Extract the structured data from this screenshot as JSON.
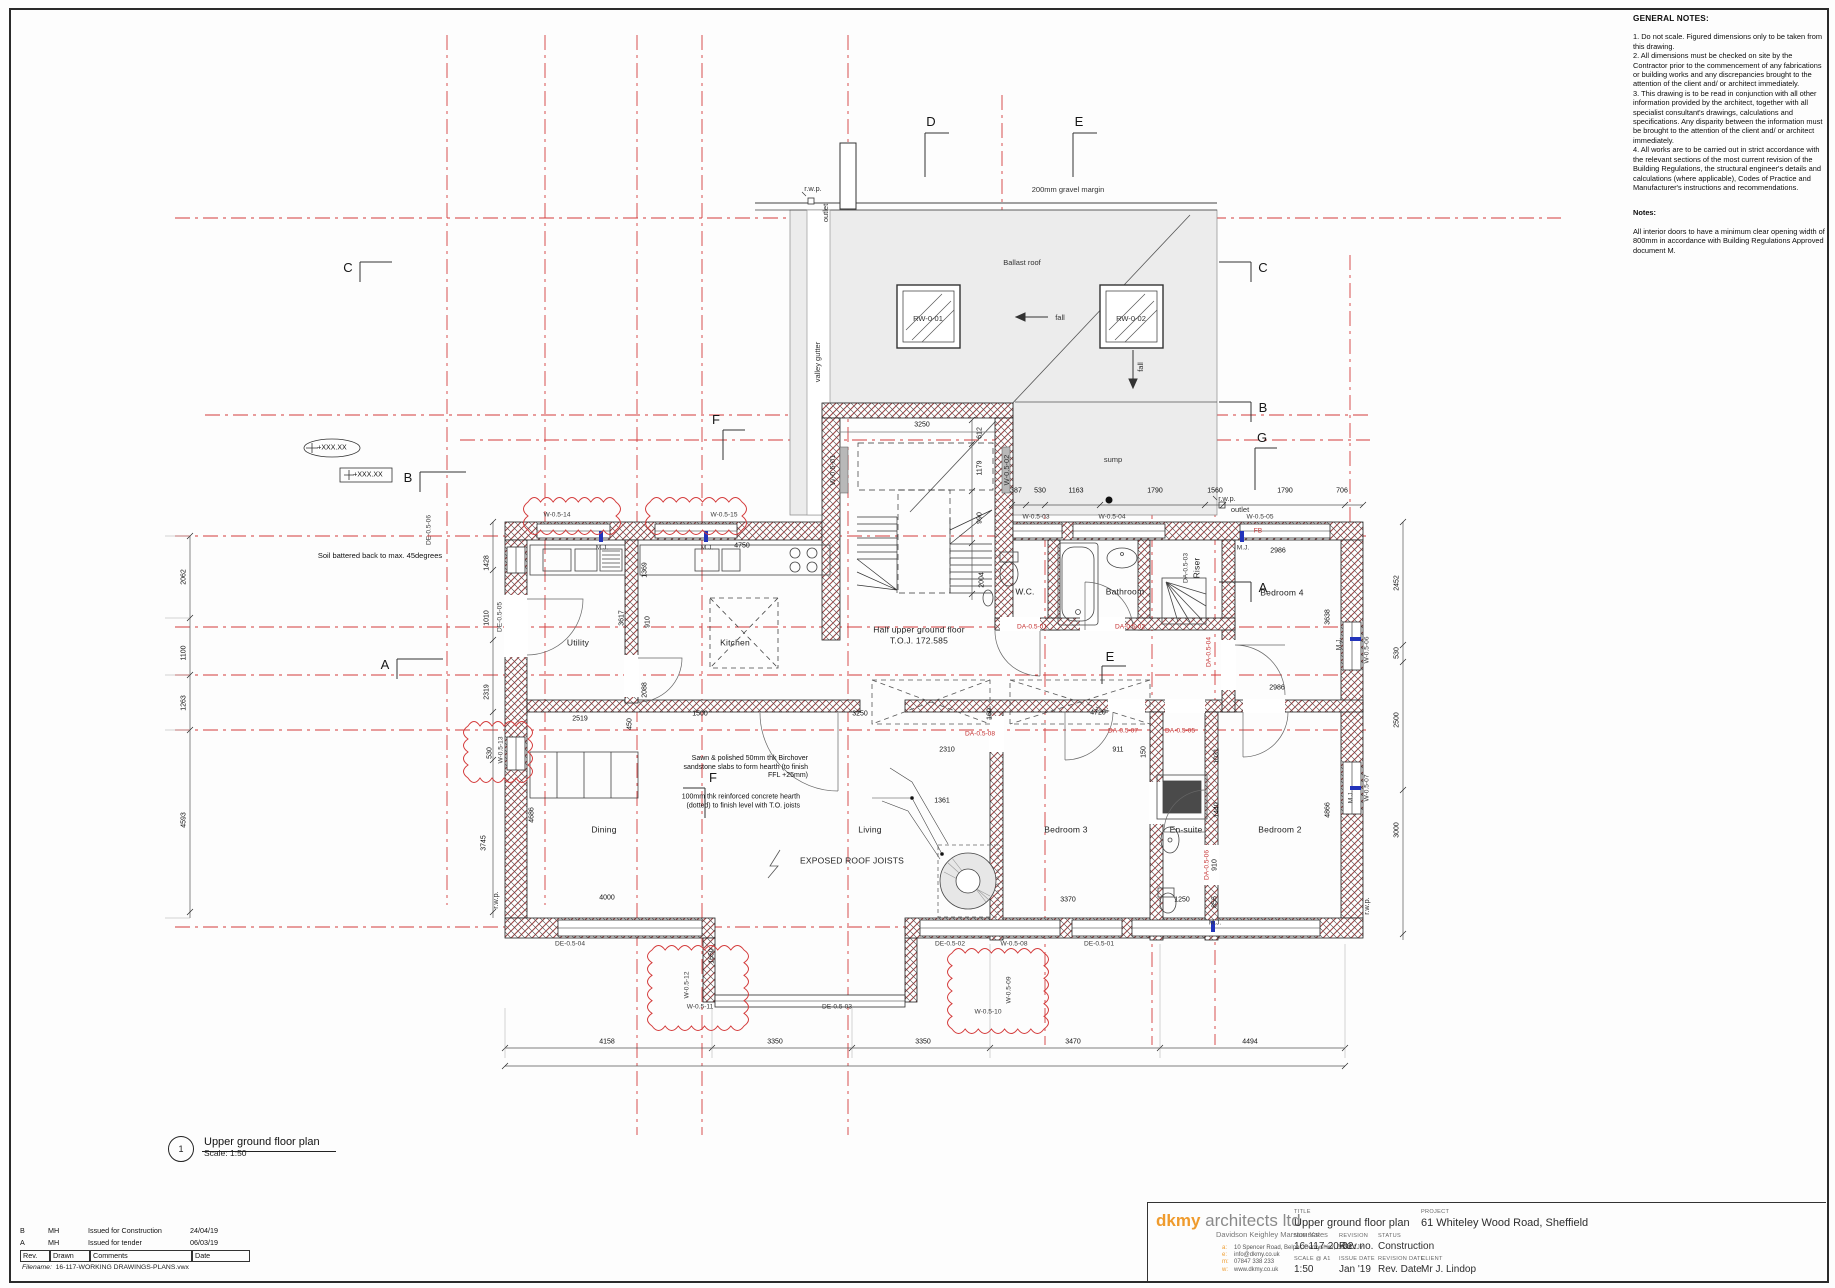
{
  "sheet": {
    "type": "architectural drawing"
  },
  "general_notes": {
    "heading": "GENERAL NOTES:",
    "body": "1. Do not scale. Figured dimensions only to be taken from this drawing.\n2. All dimensions must be checked on site by the Contractor prior to the commencement of any fabrications or building works and any discrepancies brought to the attention of the client and/ or architect immediately.\n3. This drawing is to be read in conjunction with all other information provided by the architect, together with all specialist consultant's drawings, calculations and specifications. Any disparity between the information must be brought to the attention of the client and/ or architect immediately.\n4. All works are to be carried out in strict accordance with the relevant sections of the most current revision of the Building Regulations, the structural engineer's details and calculations (where applicable), Codes of Practice and Manufacturer's instructions and recommendations.",
    "notes_heading": "Notes:",
    "notes_body": "All interior doors to have a minimum clear opening width of 800mm in accordance with Building Regulations Approved document M."
  },
  "plan_title": {
    "number": "1",
    "title": "Upper ground floor plan",
    "scale": "Scale: 1:50"
  },
  "revision_table": {
    "rows": [
      {
        "rev": "B",
        "drawn": "MH",
        "comments": "Issued for Construction",
        "date": "24/04/19"
      },
      {
        "rev": "A",
        "drawn": "MH",
        "comments": "Issued for tender",
        "date": "06/03/19"
      }
    ],
    "header": {
      "rev": "Rev.",
      "drawn": "Drawn",
      "comments": "Comments",
      "date": "Date"
    },
    "filename_label": "Filename:",
    "filename": "16-117-WORKING DRAWINGS-PLANS.vwx"
  },
  "title_block": {
    "logo_bold": "dkmy",
    "logo_rest": " architects ltd",
    "logo_sub": "Davidson Keighley Marston Yates",
    "contact": [
      {
        "k": "a:",
        "v": "10 Spencer Road, Belper, Derbyshire, DE56 1JY"
      },
      {
        "k": "e:",
        "v": "info@dkmy.co.uk"
      },
      {
        "k": "m:",
        "v": "07847 338 233"
      },
      {
        "k": "w:",
        "v": "www.dkmy.co.uk"
      }
    ],
    "title_label": "TITLE",
    "title": "Upper ground floor plan",
    "number_label": "NUMBER",
    "number": "16-117-20-02",
    "revision_label": "REVISION",
    "revision": "Rev no.",
    "status_label": "STATUS",
    "status": "Construction",
    "scale_label": "SCALE @ A1",
    "scale": "1:50",
    "issue_label": "ISSUE DATE",
    "issue": "Jan '19",
    "revdate_label": "REVISION DATE",
    "revdate": "Rev. Date",
    "project_label": "PROJECT",
    "project": "61 Whiteley Wood Road, Sheffield",
    "client_label": "CLIENT",
    "client": "Mr J. Lindop",
    "accent_color": "#ef9b2d"
  },
  "plan": {
    "grid_color": "#d43c3c",
    "rooms": [
      {
        "t": "Utility",
        "x": 578,
        "y": 643
      },
      {
        "t": "Kitchen",
        "x": 735,
        "y": 643
      },
      {
        "t": "Half upper ground floor",
        "x": 919,
        "y": 630
      },
      {
        "t": "T.O.J. 172.585",
        "x": 919,
        "y": 641
      },
      {
        "t": "W.C.",
        "x": 1025,
        "y": 592
      },
      {
        "t": "Bathroom",
        "x": 1125,
        "y": 592
      },
      {
        "t": "Riser",
        "x": 1197,
        "y": 568,
        "r": 1
      },
      {
        "t": "Bedroom 4",
        "x": 1282,
        "y": 593
      },
      {
        "t": "Dining",
        "x": 604,
        "y": 830
      },
      {
        "t": "Living",
        "x": 870,
        "y": 830
      },
      {
        "t": "EXPOSED ROOF JOISTS",
        "x": 852,
        "y": 861
      },
      {
        "t": "Bedroom 3",
        "x": 1066,
        "y": 830
      },
      {
        "t": "En-suite",
        "x": 1186,
        "y": 830
      },
      {
        "t": "Bedroom 2",
        "x": 1280,
        "y": 830
      }
    ],
    "roof_labels": [
      {
        "t": "200mm gravel margin",
        "x": 1068,
        "y": 190
      },
      {
        "t": "Ballast roof",
        "x": 1022,
        "y": 263
      },
      {
        "t": "RW-0-01",
        "x": 928,
        "y": 319
      },
      {
        "t": "RW-0-02",
        "x": 1131,
        "y": 319
      },
      {
        "t": "fall",
        "x": 1060,
        "y": 318
      },
      {
        "t": "fall",
        "x": 1141,
        "y": 367,
        "r": 1
      },
      {
        "t": "sump",
        "x": 1113,
        "y": 460
      },
      {
        "t": "valley gutter",
        "x": 818,
        "y": 362,
        "r": 1
      },
      {
        "t": "r.w.p.",
        "x": 813,
        "y": 189
      },
      {
        "t": "outlet",
        "x": 826,
        "y": 213,
        "r": 1
      },
      {
        "t": "r.w.p.",
        "x": 1227,
        "y": 499
      },
      {
        "t": "outlet",
        "x": 1240,
        "y": 510
      },
      {
        "t": "r.w.p.",
        "x": 496,
        "y": 900,
        "r": 1
      },
      {
        "t": "r.w.p.",
        "x": 1367,
        "y": 906,
        "r": 1
      },
      {
        "t": "W-0.5-01",
        "x": 833,
        "y": 470,
        "r": 1
      },
      {
        "t": "W-0.5-02",
        "x": 1007,
        "y": 470,
        "r": 1
      }
    ],
    "grid_letters": [
      {
        "t": "D",
        "x": 931,
        "y": 122
      },
      {
        "t": "E",
        "x": 1079,
        "y": 122
      },
      {
        "t": "C",
        "x": 348,
        "y": 268
      },
      {
        "t": "C",
        "x": 1263,
        "y": 268
      },
      {
        "t": "B",
        "x": 408,
        "y": 478
      },
      {
        "t": "B",
        "x": 1263,
        "y": 408
      },
      {
        "t": "A",
        "x": 385,
        "y": 665
      },
      {
        "t": "A",
        "x": 1263,
        "y": 588
      },
      {
        "t": "F",
        "x": 716,
        "y": 420
      },
      {
        "t": "F",
        "x": 713,
        "y": 778
      },
      {
        "t": "G",
        "x": 1262,
        "y": 438
      },
      {
        "t": "E",
        "x": 1110,
        "y": 657
      }
    ],
    "dims": [
      {
        "t": "387",
        "x": 1016,
        "y": 491
      },
      {
        "t": "530",
        "x": 1040,
        "y": 491
      },
      {
        "t": "1163",
        "x": 1076,
        "y": 491
      },
      {
        "t": "1790",
        "x": 1155,
        "y": 491
      },
      {
        "t": "1560",
        "x": 1215,
        "y": 491
      },
      {
        "t": "1790",
        "x": 1285,
        "y": 491
      },
      {
        "t": "706",
        "x": 1342,
        "y": 491
      },
      {
        "t": "3250",
        "x": 922,
        "y": 425
      },
      {
        "t": "612",
        "x": 980,
        "y": 433,
        "r": 1
      },
      {
        "t": "1179",
        "x": 980,
        "y": 468,
        "r": 1
      },
      {
        "t": "990",
        "x": 980,
        "y": 518,
        "r": 1
      },
      {
        "t": "2004",
        "x": 982,
        "y": 580,
        "r": 1
      },
      {
        "t": "2062",
        "x": 184,
        "y": 577,
        "r": 1
      },
      {
        "t": "1100",
        "x": 184,
        "y": 653,
        "r": 1
      },
      {
        "t": "1263",
        "x": 184,
        "y": 703,
        "r": 1
      },
      {
        "t": "4593",
        "x": 184,
        "y": 820,
        "r": 1
      },
      {
        "t": "1428",
        "x": 487,
        "y": 563,
        "r": 1
      },
      {
        "t": "1010",
        "x": 487,
        "y": 618,
        "r": 1
      },
      {
        "t": "2319",
        "x": 487,
        "y": 692,
        "r": 1
      },
      {
        "t": "530",
        "x": 490,
        "y": 753,
        "r": 1
      },
      {
        "t": "3745",
        "x": 484,
        "y": 843,
        "r": 1
      },
      {
        "t": "4686",
        "x": 532,
        "y": 815,
        "r": 1
      },
      {
        "t": "1369",
        "x": 645,
        "y": 570,
        "r": 1
      },
      {
        "t": "3617",
        "x": 622,
        "y": 618,
        "r": 1
      },
      {
        "t": "910",
        "x": 648,
        "y": 622,
        "r": 1
      },
      {
        "t": "2088",
        "x": 645,
        "y": 690,
        "r": 1
      },
      {
        "t": "4750",
        "x": 742,
        "y": 546
      },
      {
        "t": "2519",
        "x": 580,
        "y": 719
      },
      {
        "t": "450",
        "x": 630,
        "y": 724,
        "r": 1
      },
      {
        "t": "1500",
        "x": 700,
        "y": 714
      },
      {
        "t": "3250",
        "x": 860,
        "y": 714
      },
      {
        "t": "160",
        "x": 990,
        "y": 714,
        "r": 1
      },
      {
        "t": "4720",
        "x": 1098,
        "y": 713
      },
      {
        "t": "4000",
        "x": 607,
        "y": 898
      },
      {
        "t": "1650",
        "x": 712,
        "y": 956,
        "r": 1
      },
      {
        "t": "1361",
        "x": 942,
        "y": 801
      },
      {
        "t": "2310",
        "x": 947,
        "y": 750
      },
      {
        "t": "911",
        "x": 1118,
        "y": 750
      },
      {
        "t": "150",
        "x": 1144,
        "y": 752,
        "r": 1
      },
      {
        "t": "3370",
        "x": 1068,
        "y": 900
      },
      {
        "t": "1250",
        "x": 1182,
        "y": 900
      },
      {
        "t": "2986",
        "x": 1278,
        "y": 551
      },
      {
        "t": "2986",
        "x": 1277,
        "y": 688
      },
      {
        "t": "3638",
        "x": 1328,
        "y": 617,
        "r": 1
      },
      {
        "t": "1031",
        "x": 1217,
        "y": 756,
        "r": 1
      },
      {
        "t": "1440",
        "x": 1217,
        "y": 810,
        "r": 1
      },
      {
        "t": "910",
        "x": 1215,
        "y": 865,
        "r": 1
      },
      {
        "t": "855",
        "x": 1215,
        "y": 902,
        "r": 1
      },
      {
        "t": "4866",
        "x": 1328,
        "y": 810,
        "r": 1
      },
      {
        "t": "2452",
        "x": 1397,
        "y": 583,
        "r": 1
      },
      {
        "t": "530",
        "x": 1397,
        "y": 653,
        "r": 1
      },
      {
        "t": "2500",
        "x": 1397,
        "y": 720,
        "r": 1
      },
      {
        "t": "3000",
        "x": 1397,
        "y": 830,
        "r": 1
      },
      {
        "t": "4158",
        "x": 607,
        "y": 1042
      },
      {
        "t": "3350",
        "x": 775,
        "y": 1042
      },
      {
        "t": "3350",
        "x": 923,
        "y": 1042
      },
      {
        "t": "3470",
        "x": 1073,
        "y": 1042
      },
      {
        "t": "4494",
        "x": 1250,
        "y": 1042
      }
    ],
    "tags": [
      {
        "t": "W-0.5-14",
        "x": 557,
        "y": 516
      },
      {
        "t": "W-0.5-15",
        "x": 724,
        "y": 516
      },
      {
        "t": "W-0.5-03",
        "x": 1036,
        "y": 518
      },
      {
        "t": "W-0.5-04",
        "x": 1112,
        "y": 518
      },
      {
        "t": "W-0.5-05",
        "x": 1260,
        "y": 518
      },
      {
        "t": "W-0.5-06",
        "x": 1368,
        "y": 650,
        "r": 1
      },
      {
        "t": "W-0.5-07",
        "x": 1368,
        "y": 788,
        "r": 1
      },
      {
        "t": "DE-0.5-02",
        "x": 950,
        "y": 945
      },
      {
        "t": "W-0.5-08",
        "x": 1014,
        "y": 945
      },
      {
        "t": "DE-0.5-01",
        "x": 1099,
        "y": 945
      },
      {
        "t": "DE-0.5-04",
        "x": 570,
        "y": 945
      },
      {
        "t": "DE-0.5-03",
        "x": 837,
        "y": 1008
      },
      {
        "t": "W-0.5-11",
        "x": 700,
        "y": 1008
      },
      {
        "t": "W-0.5-12",
        "x": 688,
        "y": 985,
        "r": 1
      },
      {
        "t": "W-0.5-09",
        "x": 1010,
        "y": 990,
        "r": 1
      },
      {
        "t": "W-0.5-10",
        "x": 988,
        "y": 1013
      },
      {
        "t": "DE-0.5-05",
        "x": 501,
        "y": 617,
        "r": 1
      },
      {
        "t": "DE-0.5-06",
        "x": 430,
        "y": 530,
        "r": 1
      },
      {
        "t": "W-0.5-13",
        "x": 502,
        "y": 750,
        "r": 1
      },
      {
        "t": "DA-0.5-03",
        "x": 1187,
        "y": 568,
        "r": 1
      },
      {
        "t": "DA-0.5-01",
        "x": 1032,
        "y": 628,
        "c": "red"
      },
      {
        "t": "DA-0.5-02",
        "x": 1130,
        "y": 628,
        "c": "red"
      },
      {
        "t": "DA-0.5-04",
        "x": 1210,
        "y": 652,
        "r": 1,
        "c": "red"
      },
      {
        "t": "DA-0.5-05",
        "x": 1180,
        "y": 732,
        "c": "red"
      },
      {
        "t": "DA-0.5-07",
        "x": 1123,
        "y": 732,
        "c": "red"
      },
      {
        "t": "DA-0.5-08",
        "x": 980,
        "y": 735,
        "c": "red"
      },
      {
        "t": "DA-0.5-06",
        "x": 1208,
        "y": 865,
        "r": 1,
        "c": "red"
      },
      {
        "t": "FB",
        "x": 1258,
        "y": 532,
        "c": "red"
      },
      {
        "t": "M.J.",
        "x": 602,
        "y": 549
      },
      {
        "t": "M.J.",
        "x": 707,
        "y": 549
      },
      {
        "t": "M.J.",
        "x": 1243,
        "y": 549
      },
      {
        "t": "M.J.",
        "x": 1340,
        "y": 644,
        "r": 1
      },
      {
        "t": "M.J.",
        "x": 1215,
        "y": 924
      },
      {
        "t": "M.J.",
        "x": 1352,
        "y": 797,
        "r": 1
      }
    ],
    "annotations": {
      "soil": {
        "t": "Soil battered back to max. 45degrees",
        "x": 380,
        "y": 556
      },
      "level_ellipse": {
        "t": "+XXX.XX",
        "x": 332,
        "y": 448
      },
      "level_box": {
        "t": "+XXX.XX",
        "x": 366,
        "y": 475
      },
      "hearth_note_1": "Sawn & polished 50mm thk Birchover\nsandstone slabs to form hearth (to finish\nFFL +25mm)",
      "hearth_note_2": "100mm thk reinforced concrete hearth\n(dotted) to finish level with T.O. joists"
    },
    "clouds": [
      [
        528,
        502,
        88,
        28
      ],
      [
        650,
        502,
        92,
        28
      ],
      [
        468,
        726,
        60,
        52
      ],
      [
        652,
        950,
        92,
        76
      ],
      [
        952,
        953,
        92,
        76
      ]
    ]
  }
}
